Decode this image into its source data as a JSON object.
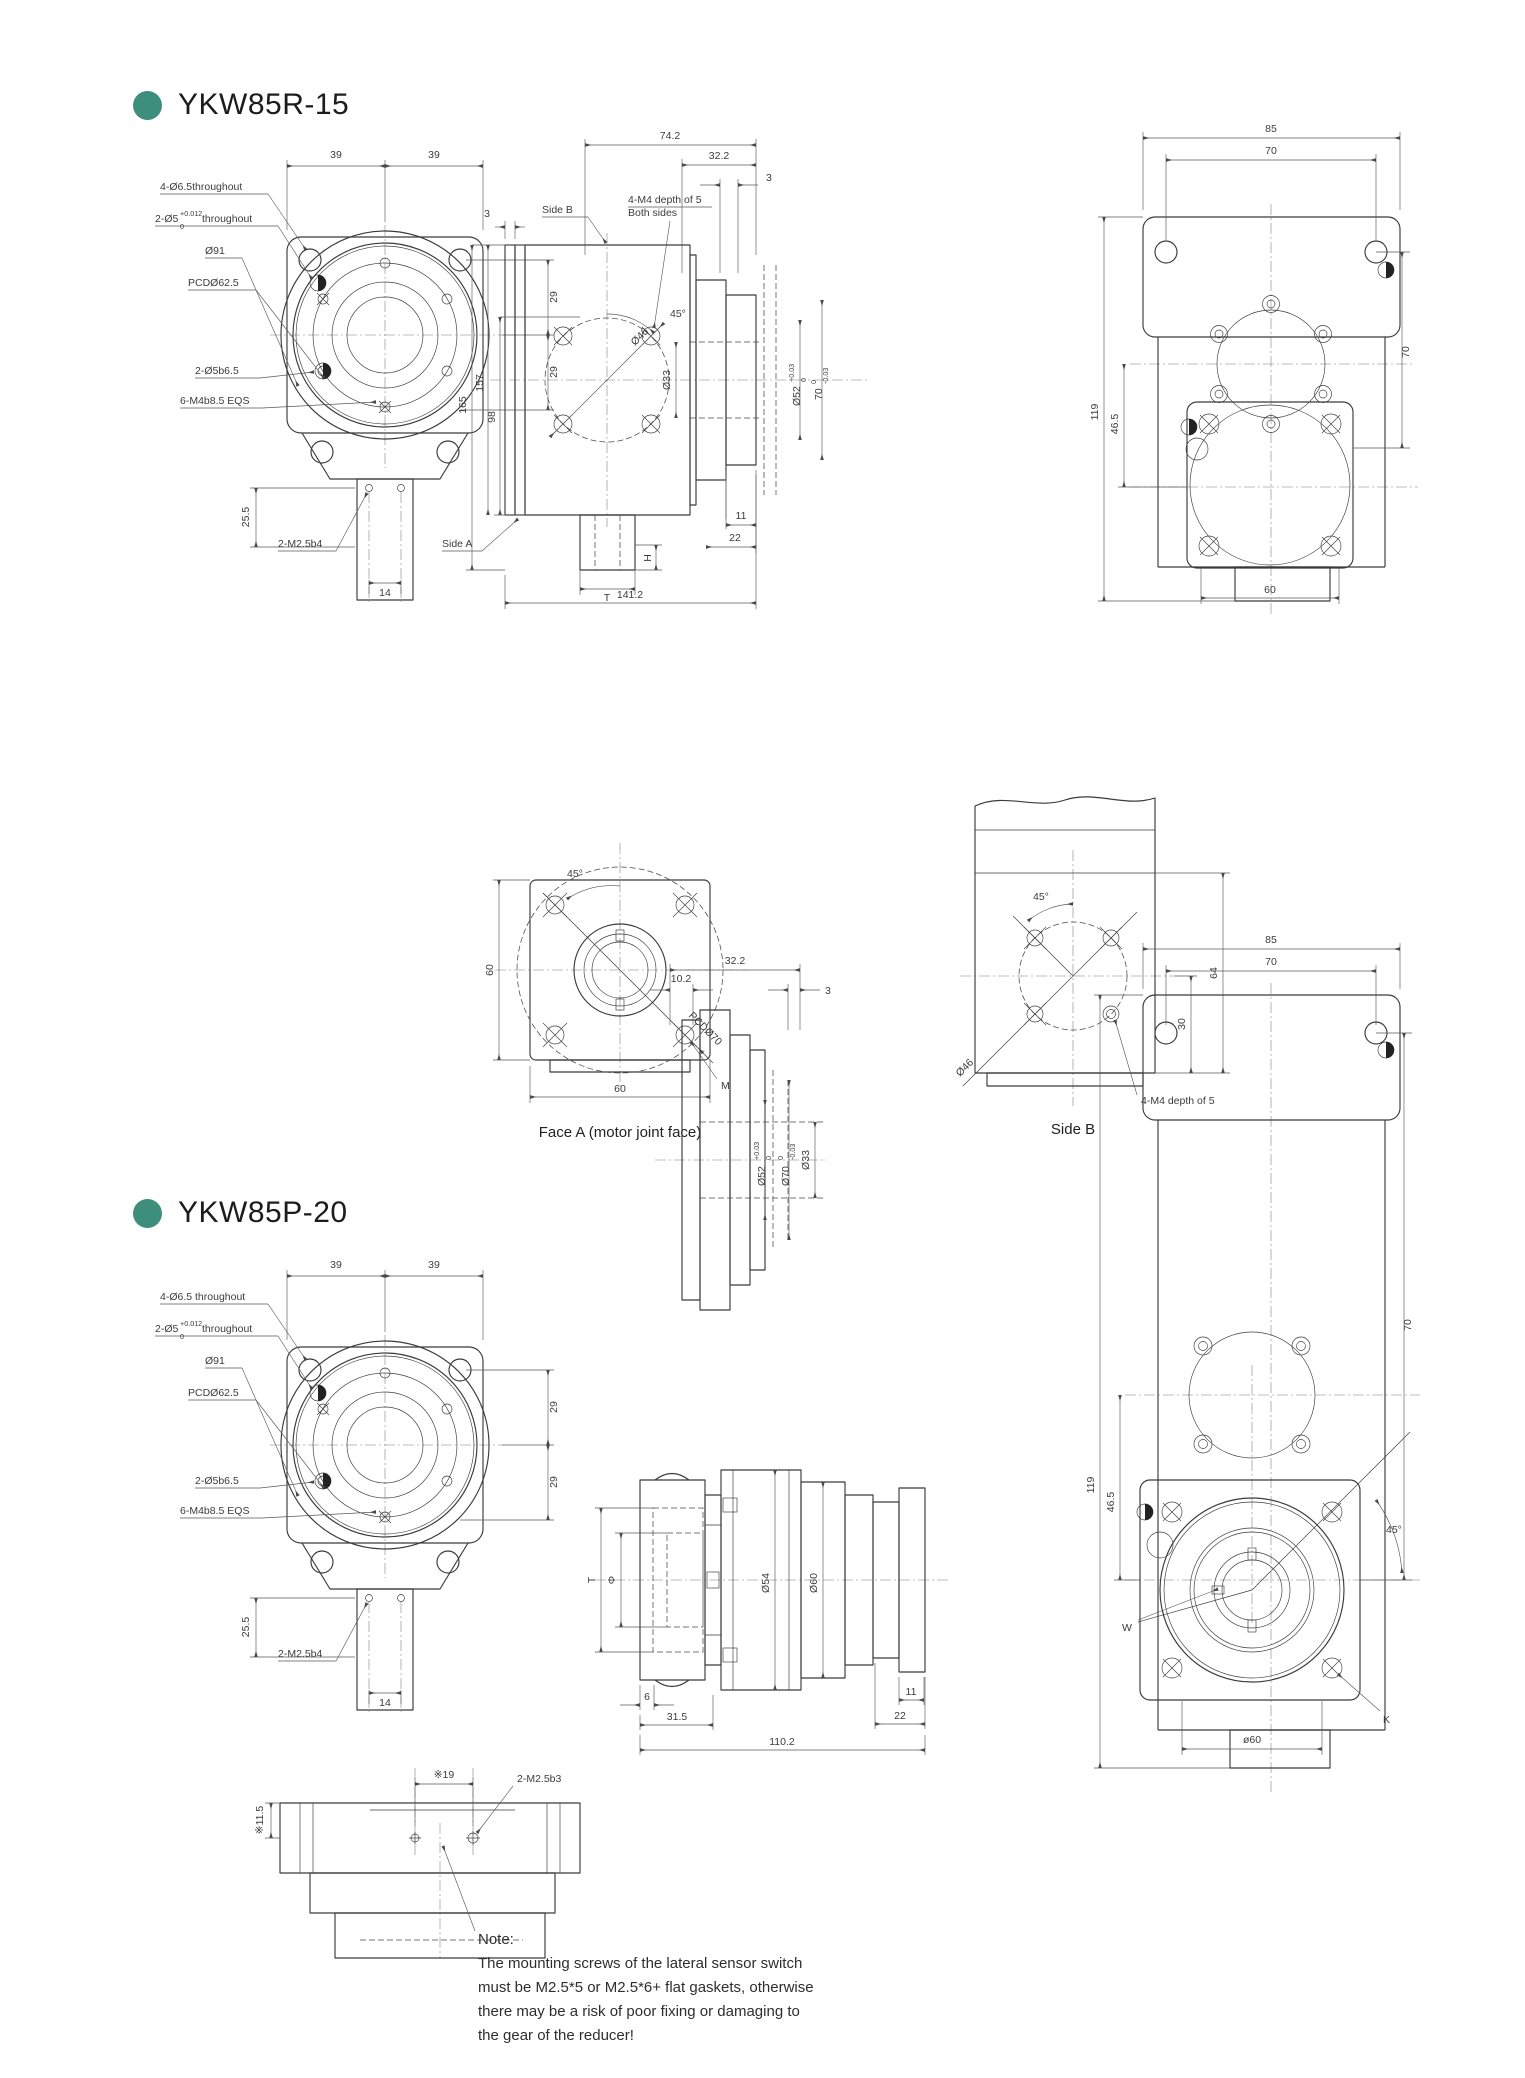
{
  "page": {
    "background": "#ffffff",
    "accent": "#3E8E7E",
    "ink": "#3b3b3b",
    "dim_ink": "#5a5a5a"
  },
  "sections": [
    {
      "title": "YKW85R-15",
      "front": {
        "leaders": {
          "l1": "4-Ø6.5throughout",
          "l2a": "2-Ø5",
          "l2sup": "+0.012",
          "l2sub": "0",
          "l2b": "throughout",
          "l3": "Ø91",
          "l4": "PCDØ62.5",
          "l5": "2-Ø5b6.5",
          "l6": "6-M4b8.5 EQS",
          "l7": "2-M2.5b4"
        },
        "dims": {
          "t1": "39",
          "t2": "39",
          "r1": "29",
          "r2": "29",
          "left": "25.5",
          "bottom": "14"
        }
      },
      "sect": {
        "dims": {
          "total": "74.2",
          "right": "32.2",
          "plate_r": "3",
          "plate_l": "3",
          "h165": "165",
          "h157": "157",
          "h98": "98",
          "bore": "Ø33",
          "d52": "Ø52",
          "d52sup": "+0.03",
          "d52sub": "0",
          "d70": "70",
          "d70sup": "0",
          "d70sub": "-0.03",
          "bolt_circle": "Ø46",
          "angle": "45°",
          "len11": "11",
          "len22": "22",
          "overall": "141.2",
          "shaft_h": "H",
          "shaft_t": "T"
        },
        "labels": {
          "side_b": "Side B",
          "m4a": "4-M4 depth of 5",
          "m4b": "Both sides",
          "side_a": "Side A"
        }
      },
      "right": {
        "dims": {
          "w": "85",
          "holes": "70",
          "h": "119",
          "off": "46.5",
          "side": "70",
          "bottom": "60"
        }
      },
      "face_a": {
        "caption": "Face A (motor joint face)",
        "dims": {
          "angle": "45°",
          "h": "60",
          "w": "60"
        },
        "labels": {
          "pcd": "PCDØ70",
          "m": "M"
        }
      },
      "side_b": {
        "caption": "Side B",
        "dims": {
          "angle": "45°",
          "bolt_circle": "Ø46",
          "h": "64",
          "off": "30"
        },
        "labels": {
          "m4": "4-M4 depth of 5"
        }
      }
    },
    {
      "title": "YKW85P-20",
      "front": {
        "leaders": {
          "l1": "4-Ø6.5 throughout",
          "l2a": "2-Ø5",
          "l2sup": "+0.012",
          "l2sub": "0",
          "l2b": "throughout",
          "l3": "Ø91",
          "l4": "PCDØ62.5",
          "l5": "2-Ø5b6.5",
          "l6": "6-M4b8.5 EQS",
          "l7": "2-M2.5b4"
        },
        "dims": {
          "t1": "39",
          "t2": "39",
          "r1": "29",
          "r2": "29",
          "left": "25.5",
          "bottom": "14"
        }
      },
      "fsect": {
        "dims": {
          "w322": "32.2",
          "w102": "10.2",
          "w3": "3",
          "d52": "Ø52",
          "d52sup": "+0.03",
          "d52sub": "0",
          "d70": "Ø70",
          "d70sup": "0",
          "d70sub": "-0.03",
          "bore": "Ø33"
        }
      },
      "inline": {
        "dims": {
          "t": "T",
          "phi": "Φ",
          "d54": "Ø54",
          "d60": "Ø60",
          "l6": "6",
          "l315": "31.5",
          "l11": "11",
          "l22": "22",
          "overall": "110.2"
        }
      },
      "right": {
        "dims": {
          "w": "85",
          "holes": "70",
          "h": "119",
          "off": "46.5",
          "side": "70",
          "bottom": "ø60",
          "angle": "45°"
        },
        "labels": {
          "kw": "W",
          "k": "K"
        }
      },
      "sensor": {
        "dims": {
          "span": "※19",
          "h": "※11.5"
        },
        "labels": {
          "screws": "2-M2.5b3"
        },
        "note_title": "Note:",
        "note_lines": [
          "The mounting screws of the lateral sensor switch",
          "must be M2.5*5 or M2.5*6+ flat gaskets, otherwise",
          "there may be a risk of poor fixing or damaging to",
          "the gear of the reducer!"
        ]
      }
    }
  ]
}
